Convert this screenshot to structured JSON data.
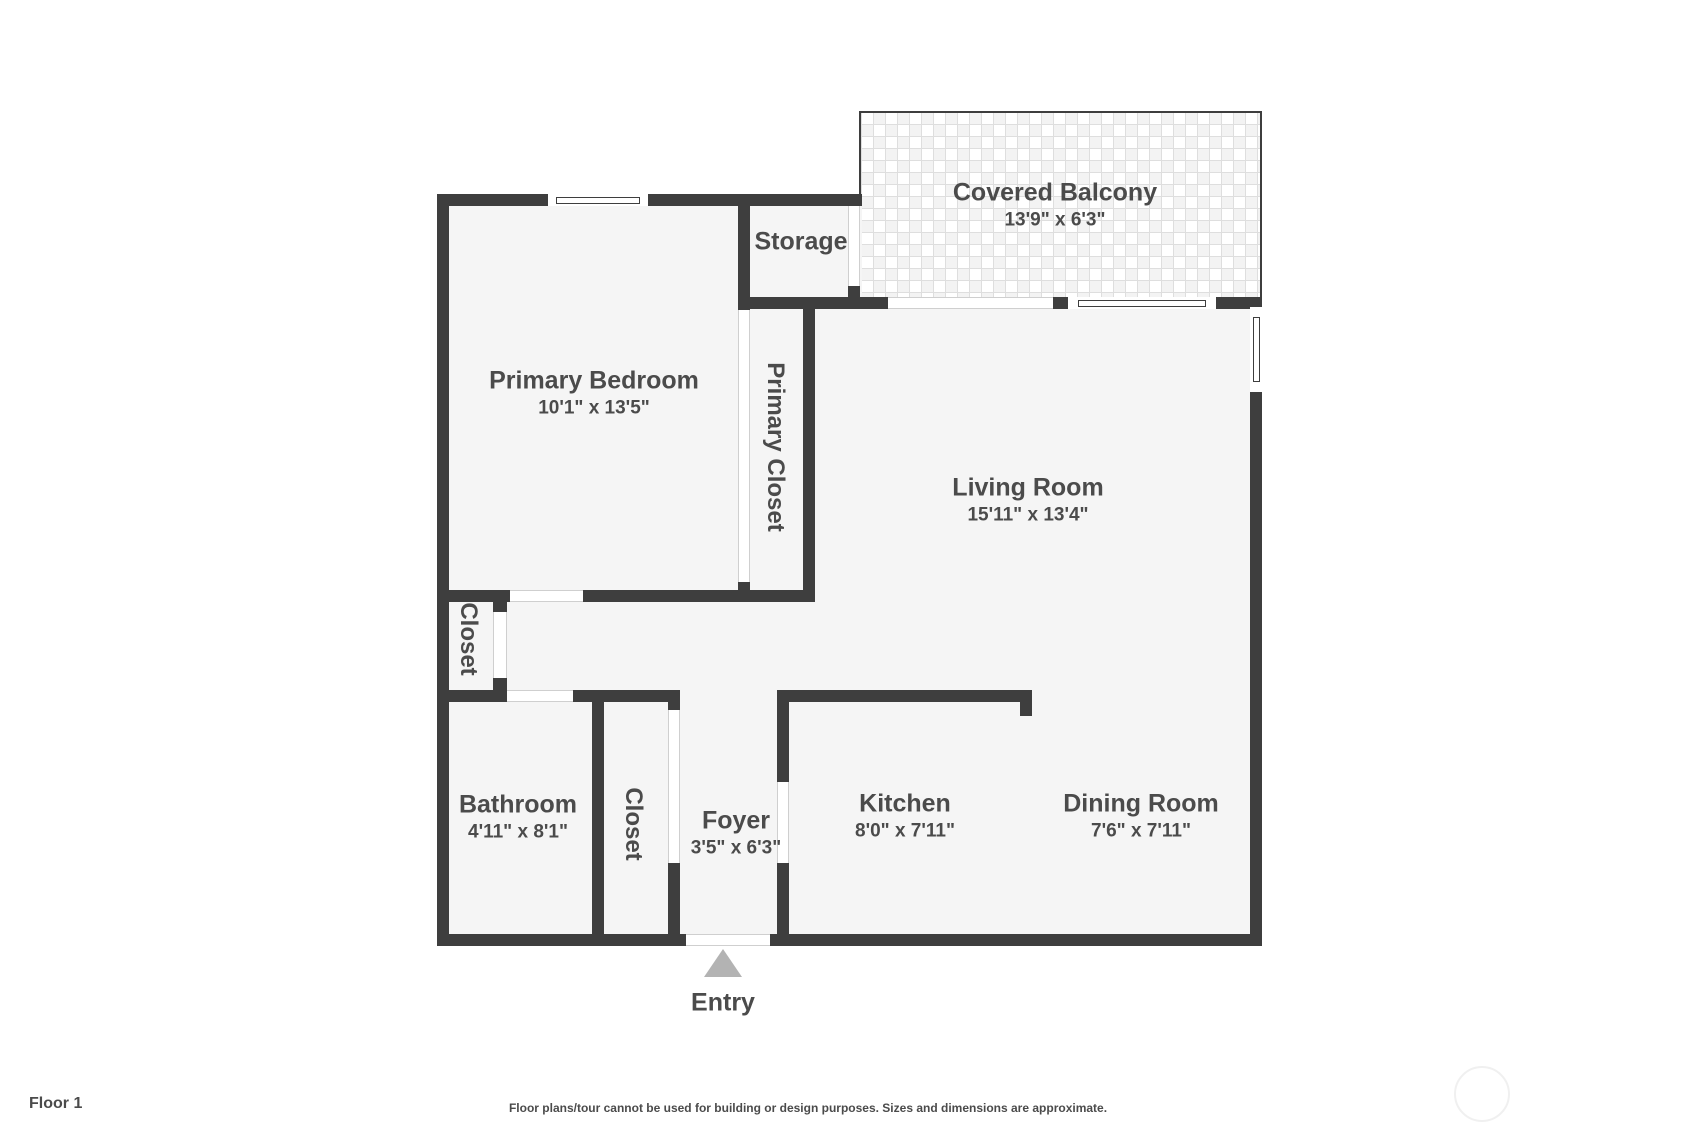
{
  "colors": {
    "wall": "#3e3e3e",
    "room_fill": "#f5f5f5",
    "text": "#4b4b4b",
    "entry_arrow": "#b3b3b3",
    "balcony_tile_line": "#dedede"
  },
  "rooms": {
    "covered_balcony": {
      "name": "Covered Balcony",
      "dims": "13'9\" x 6'3\""
    },
    "storage": {
      "name": "Storage"
    },
    "primary_bedroom": {
      "name": "Primary Bedroom",
      "dims": "10'1\" x 13'5\""
    },
    "primary_closet": {
      "name": "Primary Closet"
    },
    "living_room": {
      "name": "Living Room",
      "dims": "15'11\" x 13'4\""
    },
    "hall_closet": {
      "name": "Closet"
    },
    "bathroom": {
      "name": "Bathroom",
      "dims": "4'11\" x 8'1\""
    },
    "foyer_closet": {
      "name": "Closet"
    },
    "foyer": {
      "name": "Foyer",
      "dims": "3'5\" x 6'3\""
    },
    "kitchen": {
      "name": "Kitchen",
      "dims": "8'0\" x 7'11\""
    },
    "dining_room": {
      "name": "Dining Room",
      "dims": "7'6\" x 7'11\""
    }
  },
  "entry": {
    "label": "Entry"
  },
  "footer": {
    "floor_label": "Floor 1",
    "disclaimer": "Floor plans/tour cannot be used for building or design purposes. Sizes and dimensions are approximate."
  }
}
